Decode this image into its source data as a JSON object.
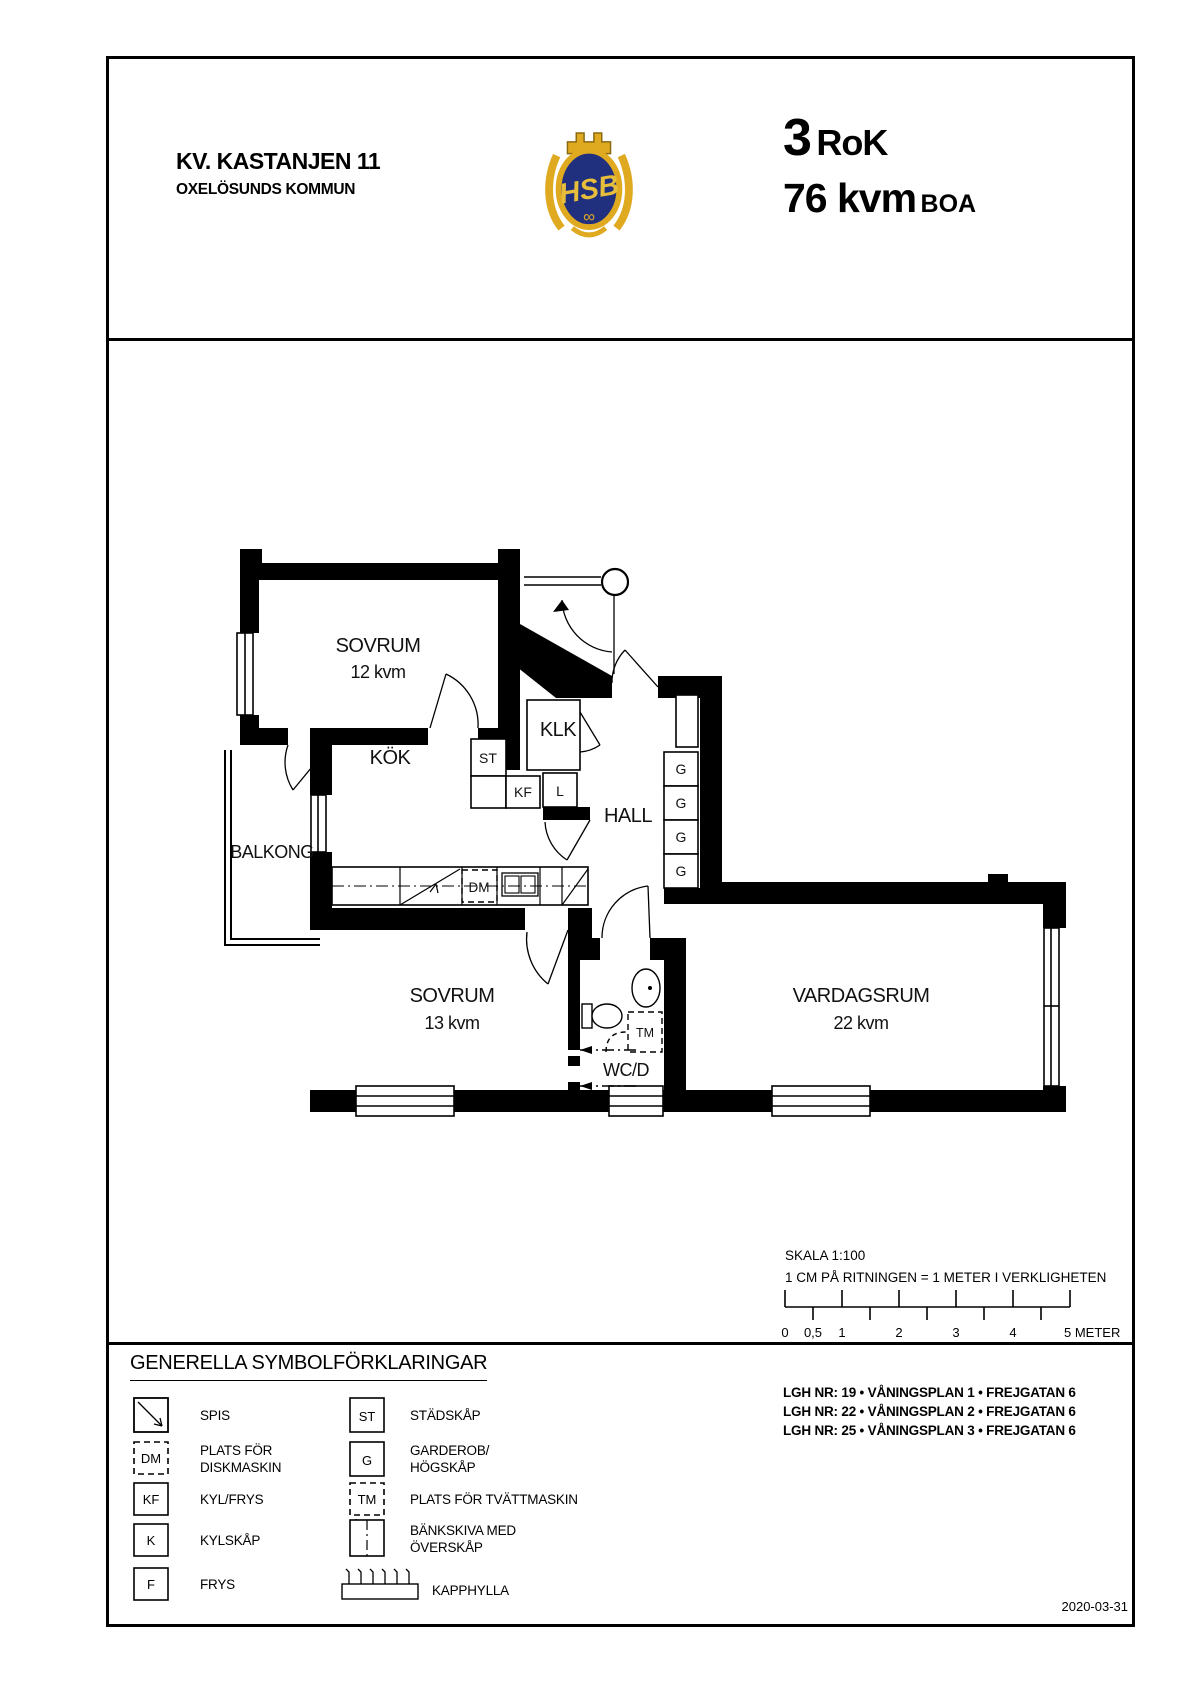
{
  "header": {
    "project_title": "KV. KASTANJEN 11",
    "municipality": "OXELÖSUNDS KOMMUN",
    "logo_text": "HSB",
    "rooms_value": "3",
    "rooms_suffix": "RoK",
    "area_value": "76 kvm",
    "area_suffix": "BOA"
  },
  "plan": {
    "rooms": {
      "sovrum12": {
        "name": "SOVRUM",
        "area": "12 kvm"
      },
      "sovrum13": {
        "name": "SOVRUM",
        "area": "13 kvm"
      },
      "vardagsrum": {
        "name": "VARDAGSRUM",
        "area": "22 kvm"
      },
      "kok": "KÖK",
      "hall": "HALL",
      "klk": "KLK",
      "balkong": "BALKONG",
      "wcd": "WC/D"
    },
    "symbols": {
      "st": "ST",
      "kf": "KF",
      "l": "L",
      "dm": "DM",
      "tm": "TM",
      "g": "G"
    }
  },
  "scale": {
    "title": "SKALA 1:100",
    "subtitle": "1 CM PÅ RITNINGEN = 1 METER I VERKLIGHETEN",
    "tick_labels": [
      "0",
      "0,5",
      "1",
      "2",
      "3",
      "4",
      "5 METER"
    ]
  },
  "legend": {
    "title": "GENERELLA SYMBOLFÖRKLARINGAR",
    "items_left": [
      {
        "symbol": "spis",
        "label_lines": [
          "SPIS"
        ]
      },
      {
        "symbol": "dm",
        "symbol_text": "DM",
        "label_lines": [
          "PLATS FÖR",
          "DISKMASKIN"
        ]
      },
      {
        "symbol": "box",
        "symbol_text": "KF",
        "label_lines": [
          "KYL/FRYS"
        ]
      },
      {
        "symbol": "box",
        "symbol_text": "K",
        "label_lines": [
          "KYLSKÅP"
        ]
      },
      {
        "symbol": "box",
        "symbol_text": "F",
        "label_lines": [
          "FRYS"
        ]
      }
    ],
    "items_right": [
      {
        "symbol": "box",
        "symbol_text": "ST",
        "label_lines": [
          "STÄDSKÅP"
        ]
      },
      {
        "symbol": "box",
        "symbol_text": "G",
        "label_lines": [
          "GARDEROB/",
          "HÖGSKÅP"
        ]
      },
      {
        "symbol": "tm",
        "symbol_text": "TM",
        "label_lines": [
          "PLATS FÖR TVÄTTMASKIN"
        ]
      },
      {
        "symbol": "bankskiva",
        "label_lines": [
          "BÄNKSKIVA MED",
          "ÖVERSKÅP"
        ]
      },
      {
        "symbol": "kapphylla",
        "label_lines": [
          "KAPPHYLLA"
        ]
      }
    ]
  },
  "apartments": [
    "LGH NR: 19 • VÅNINGSPLAN 1 • FREJGATAN 6",
    "LGH NR: 22 • VÅNINGSPLAN 2 • FREJGATAN 6",
    "LGH NR: 25 • VÅNINGSPLAN 3 • FREJGATAN 6"
  ],
  "date": "2020-03-31",
  "colors": {
    "wall": "#000000",
    "logo_gold": "#DFA920",
    "logo_blue": "#20307E"
  }
}
